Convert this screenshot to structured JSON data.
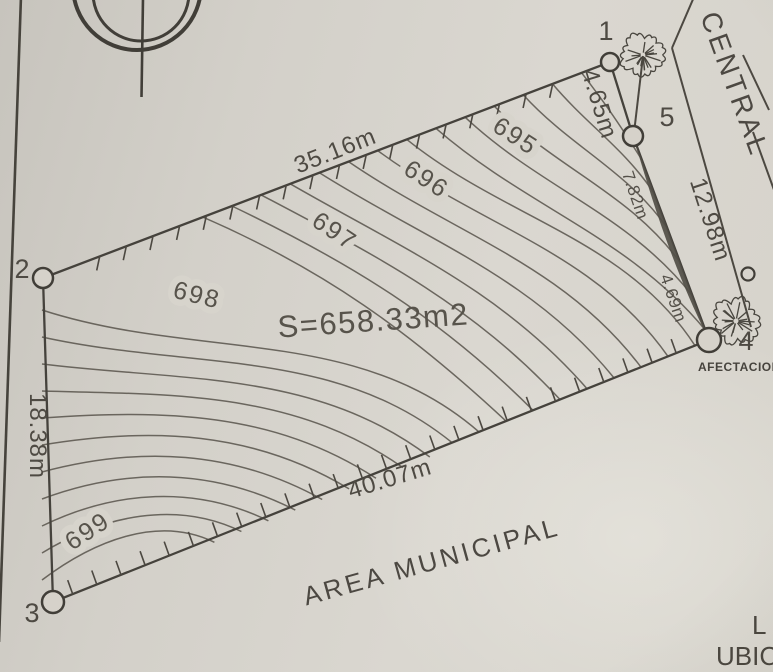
{
  "colors": {
    "ink": "#4e4a43",
    "contour": "#5b574f",
    "paper": "#d6d2ca"
  },
  "plan": {
    "surface_area": "S=658.33m2",
    "street_name": "CENTRAL",
    "municipal_zone": "AREA MUNICIPAL",
    "affectation": "AFECTACION",
    "points": {
      "p1": "1",
      "p2": "2",
      "p3": "3",
      "p4": "4",
      "p5": "5"
    },
    "dimensions": {
      "top_edge": "35.16m",
      "left_edge": "18.38m",
      "bottom_edge": "40.07m",
      "street_frontage": "12.98m",
      "seg_1_to_5": "4.65m",
      "seg_5_mid": "7.82m",
      "seg_mid_4": "4.69m"
    },
    "contour_labels": {
      "c695": "695",
      "c696": "696",
      "c697": "697",
      "c698": "698",
      "c699": "699"
    },
    "corner_texts": {
      "l": "L",
      "ubicacion": "UBIC"
    }
  }
}
